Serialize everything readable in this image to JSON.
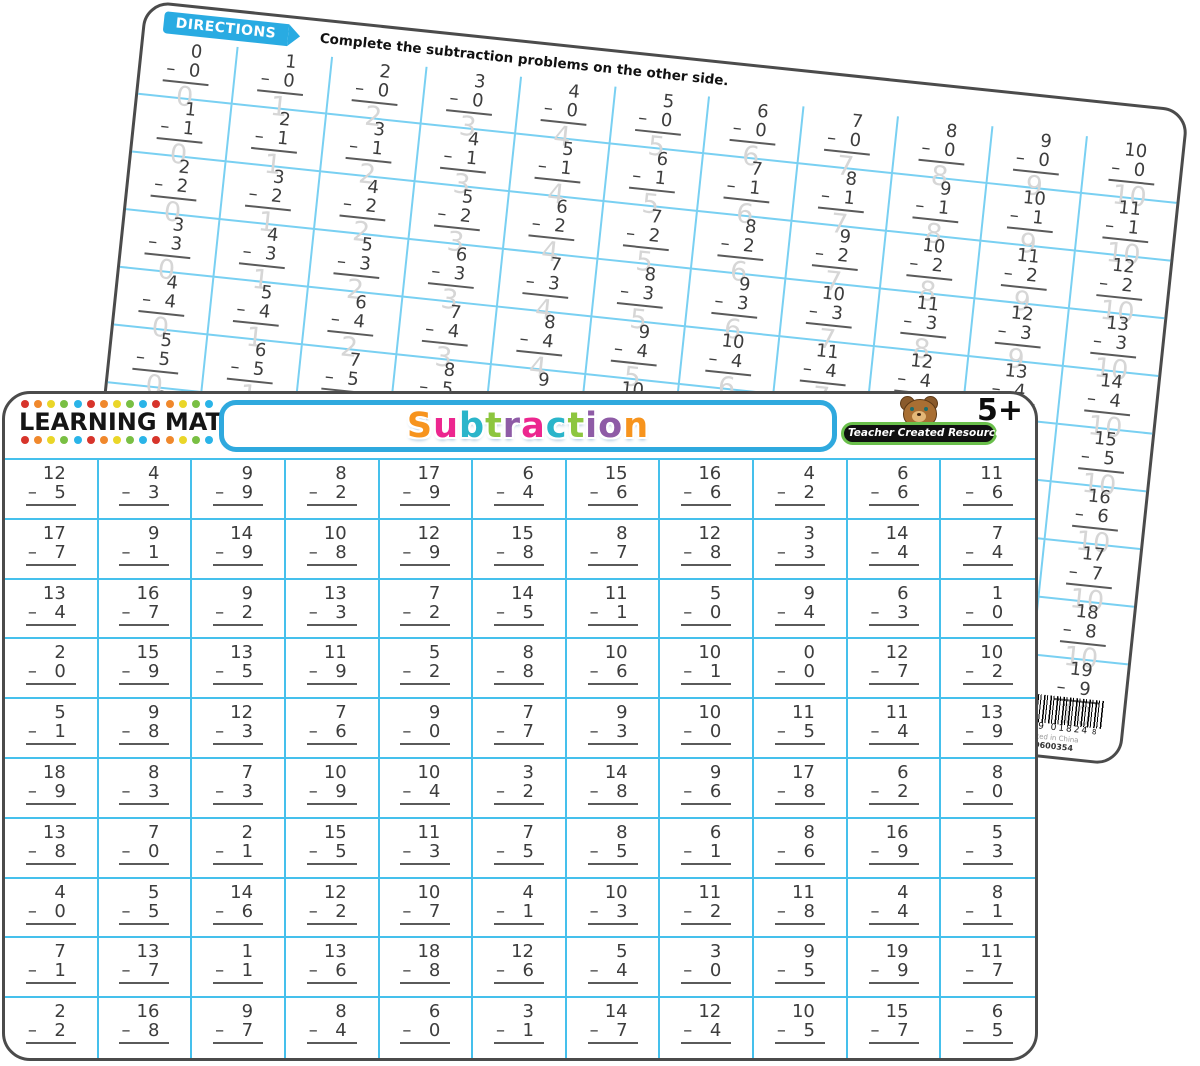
{
  "colors": {
    "mat_border": "#4b4b4b",
    "front_grid_line": "#45c0ec",
    "back_grid_line": "#79d0f2",
    "directions_blue": "#29abe2",
    "banner_blue": "#2fa9de",
    "logo_green": "#6abf4b",
    "answer_ghost_gray": "#d6d6d6",
    "digit_color": "#3d3d3d"
  },
  "back_mat": {
    "directions_label": "DIRECTIONS",
    "directions_text": "Complete the subtraction problems on the other side.",
    "grid": {
      "rows": 10,
      "cols": 11,
      "problems": [
        [
          [
            0,
            0,
            0
          ],
          [
            1,
            0,
            1
          ],
          [
            2,
            0,
            2
          ],
          [
            3,
            0,
            3
          ],
          [
            4,
            0,
            4
          ],
          [
            5,
            0,
            5
          ],
          [
            6,
            0,
            6
          ],
          [
            7,
            0,
            7
          ],
          [
            8,
            0,
            8
          ],
          [
            9,
            0,
            9
          ],
          [
            10,
            0,
            10
          ]
        ],
        [
          [
            1,
            1,
            0
          ],
          [
            2,
            1,
            1
          ],
          [
            3,
            1,
            2
          ],
          [
            4,
            1,
            3
          ],
          [
            5,
            1,
            4
          ],
          [
            6,
            1,
            5
          ],
          [
            7,
            1,
            6
          ],
          [
            8,
            1,
            7
          ],
          [
            9,
            1,
            8
          ],
          [
            10,
            1,
            9
          ],
          [
            11,
            1,
            10
          ]
        ],
        [
          [
            2,
            2,
            0
          ],
          [
            3,
            2,
            1
          ],
          [
            4,
            2,
            2
          ],
          [
            5,
            2,
            3
          ],
          [
            6,
            2,
            4
          ],
          [
            7,
            2,
            5
          ],
          [
            8,
            2,
            6
          ],
          [
            9,
            2,
            7
          ],
          [
            10,
            2,
            8
          ],
          [
            11,
            2,
            9
          ],
          [
            12,
            2,
            10
          ]
        ],
        [
          [
            3,
            3,
            0
          ],
          [
            4,
            3,
            1
          ],
          [
            5,
            3,
            2
          ],
          [
            6,
            3,
            3
          ],
          [
            7,
            3,
            4
          ],
          [
            8,
            3,
            5
          ],
          [
            9,
            3,
            6
          ],
          [
            10,
            3,
            7
          ],
          [
            11,
            3,
            8
          ],
          [
            12,
            3,
            9
          ],
          [
            13,
            3,
            10
          ]
        ],
        [
          [
            4,
            4,
            0
          ],
          [
            5,
            4,
            1
          ],
          [
            6,
            4,
            2
          ],
          [
            7,
            4,
            3
          ],
          [
            8,
            4,
            4
          ],
          [
            9,
            4,
            5
          ],
          [
            10,
            4,
            6
          ],
          [
            11,
            4,
            7
          ],
          [
            12,
            4,
            8
          ],
          [
            13,
            4,
            9
          ],
          [
            14,
            4,
            10
          ]
        ],
        [
          [
            5,
            5,
            0
          ],
          [
            6,
            5,
            1
          ],
          [
            7,
            5,
            2
          ],
          [
            8,
            5,
            3
          ],
          [
            9,
            5,
            4
          ],
          [
            10,
            5,
            5
          ],
          [
            11,
            5,
            6
          ],
          [
            12,
            5,
            7
          ],
          [
            13,
            5,
            8
          ],
          [
            14,
            5,
            9
          ],
          [
            15,
            5,
            10
          ]
        ],
        [
          [
            6,
            6,
            0
          ],
          [
            7,
            6,
            1
          ],
          [
            8,
            6,
            2
          ],
          [
            9,
            6,
            3
          ],
          [
            10,
            6,
            4
          ],
          [
            11,
            6,
            5
          ],
          [
            12,
            6,
            6
          ],
          [
            13,
            6,
            7
          ],
          [
            14,
            6,
            8
          ],
          [
            15,
            6,
            9
          ],
          [
            16,
            6,
            10
          ]
        ],
        [
          [
            7,
            7,
            0
          ],
          [
            8,
            7,
            1
          ],
          [
            9,
            7,
            2
          ],
          [
            10,
            7,
            3
          ],
          [
            11,
            7,
            4
          ],
          [
            12,
            7,
            5
          ],
          [
            13,
            7,
            6
          ],
          [
            14,
            7,
            7
          ],
          [
            15,
            7,
            8
          ],
          [
            16,
            7,
            9
          ],
          [
            17,
            7,
            10
          ]
        ],
        [
          [
            8,
            8,
            0
          ],
          [
            9,
            8,
            1
          ],
          [
            10,
            8,
            2
          ],
          [
            11,
            8,
            3
          ],
          [
            12,
            8,
            4
          ],
          [
            13,
            8,
            5
          ],
          [
            14,
            8,
            6
          ],
          [
            15,
            8,
            7
          ],
          [
            16,
            8,
            8
          ],
          [
            17,
            8,
            9
          ],
          [
            18,
            8,
            10
          ]
        ],
        [
          [
            9,
            9,
            0
          ],
          [
            10,
            9,
            1
          ],
          [
            11,
            9,
            2
          ],
          [
            12,
            9,
            3
          ],
          [
            13,
            9,
            4
          ],
          [
            14,
            9,
            5
          ],
          [
            15,
            9,
            6
          ],
          [
            16,
            9,
            7
          ],
          [
            17,
            9,
            8
          ],
          [
            18,
            9,
            9
          ],
          [
            19,
            9,
            10
          ]
        ]
      ]
    },
    "barcode": {
      "digits": "82319 01824",
      "check_digit": "8",
      "line1": "Printed in China",
      "line2": "PO600354"
    }
  },
  "front_mat": {
    "brand_title": "LEARNING MAT",
    "dots_per_row": 15,
    "dot_colors": [
      "#d7342b",
      "#f0882c",
      "#ead628",
      "#79bf43",
      "#2ab4e8"
    ],
    "banner_title": "Subtraction",
    "title_letters": [
      {
        "ch": "S",
        "color": "#f7941e"
      },
      {
        "ch": "u",
        "color": "#ec268f"
      },
      {
        "ch": "b",
        "color": "#2bb5ca"
      },
      {
        "ch": "t",
        "color": "#8dc63f"
      },
      {
        "ch": "r",
        "color": "#8e5ba6"
      },
      {
        "ch": "a",
        "color": "#ec268f"
      },
      {
        "ch": "c",
        "color": "#2bb5ca"
      },
      {
        "ch": "t",
        "color": "#8dc63f"
      },
      {
        "ch": "i",
        "color": "#8e5ba6"
      },
      {
        "ch": "o",
        "color": "#8e5ba6"
      },
      {
        "ch": "n",
        "color": "#f7941e"
      }
    ],
    "publisher": "Teacher Created Resources",
    "age_badge": "5+",
    "grid": {
      "rows": 10,
      "cols": 11,
      "problems": [
        [
          [
            12,
            5
          ],
          [
            4,
            3
          ],
          [
            9,
            9
          ],
          [
            8,
            2
          ],
          [
            17,
            9
          ],
          [
            6,
            4
          ],
          [
            15,
            6
          ],
          [
            16,
            6
          ],
          [
            4,
            2
          ],
          [
            6,
            6
          ],
          [
            11,
            6
          ]
        ],
        [
          [
            17,
            7
          ],
          [
            9,
            1
          ],
          [
            14,
            9
          ],
          [
            10,
            8
          ],
          [
            12,
            9
          ],
          [
            15,
            8
          ],
          [
            8,
            7
          ],
          [
            12,
            8
          ],
          [
            3,
            3
          ],
          [
            14,
            4
          ],
          [
            7,
            4
          ]
        ],
        [
          [
            13,
            4
          ],
          [
            16,
            7
          ],
          [
            9,
            2
          ],
          [
            13,
            3
          ],
          [
            7,
            2
          ],
          [
            14,
            5
          ],
          [
            11,
            1
          ],
          [
            5,
            0
          ],
          [
            9,
            4
          ],
          [
            6,
            3
          ],
          [
            1,
            0
          ]
        ],
        [
          [
            2,
            0
          ],
          [
            15,
            9
          ],
          [
            13,
            5
          ],
          [
            11,
            9
          ],
          [
            5,
            2
          ],
          [
            8,
            8
          ],
          [
            10,
            6
          ],
          [
            10,
            1
          ],
          [
            0,
            0
          ],
          [
            12,
            7
          ],
          [
            10,
            2
          ]
        ],
        [
          [
            5,
            1
          ],
          [
            9,
            8
          ],
          [
            12,
            3
          ],
          [
            7,
            6
          ],
          [
            9,
            0
          ],
          [
            7,
            7
          ],
          [
            9,
            3
          ],
          [
            10,
            0
          ],
          [
            11,
            5
          ],
          [
            11,
            4
          ],
          [
            13,
            9
          ]
        ],
        [
          [
            18,
            9
          ],
          [
            8,
            3
          ],
          [
            7,
            3
          ],
          [
            10,
            9
          ],
          [
            10,
            4
          ],
          [
            3,
            2
          ],
          [
            14,
            8
          ],
          [
            9,
            6
          ],
          [
            17,
            8
          ],
          [
            6,
            2
          ],
          [
            8,
            0
          ]
        ],
        [
          [
            13,
            8
          ],
          [
            7,
            0
          ],
          [
            2,
            1
          ],
          [
            15,
            5
          ],
          [
            11,
            3
          ],
          [
            7,
            5
          ],
          [
            8,
            5
          ],
          [
            6,
            1
          ],
          [
            8,
            6
          ],
          [
            16,
            9
          ],
          [
            5,
            3
          ]
        ],
        [
          [
            4,
            0
          ],
          [
            5,
            5
          ],
          [
            14,
            6
          ],
          [
            12,
            2
          ],
          [
            10,
            7
          ],
          [
            4,
            1
          ],
          [
            10,
            3
          ],
          [
            11,
            2
          ],
          [
            11,
            8
          ],
          [
            4,
            4
          ],
          [
            8,
            1
          ]
        ],
        [
          [
            7,
            1
          ],
          [
            13,
            7
          ],
          [
            1,
            1
          ],
          [
            13,
            6
          ],
          [
            18,
            8
          ],
          [
            12,
            6
          ],
          [
            5,
            4
          ],
          [
            3,
            0
          ],
          [
            9,
            5
          ],
          [
            19,
            9
          ],
          [
            11,
            7
          ]
        ],
        [
          [
            2,
            2
          ],
          [
            16,
            8
          ],
          [
            9,
            7
          ],
          [
            8,
            4
          ],
          [
            6,
            0
          ],
          [
            3,
            1
          ],
          [
            14,
            7
          ],
          [
            12,
            4
          ],
          [
            10,
            5
          ],
          [
            15,
            7
          ],
          [
            6,
            5
          ]
        ]
      ]
    }
  }
}
